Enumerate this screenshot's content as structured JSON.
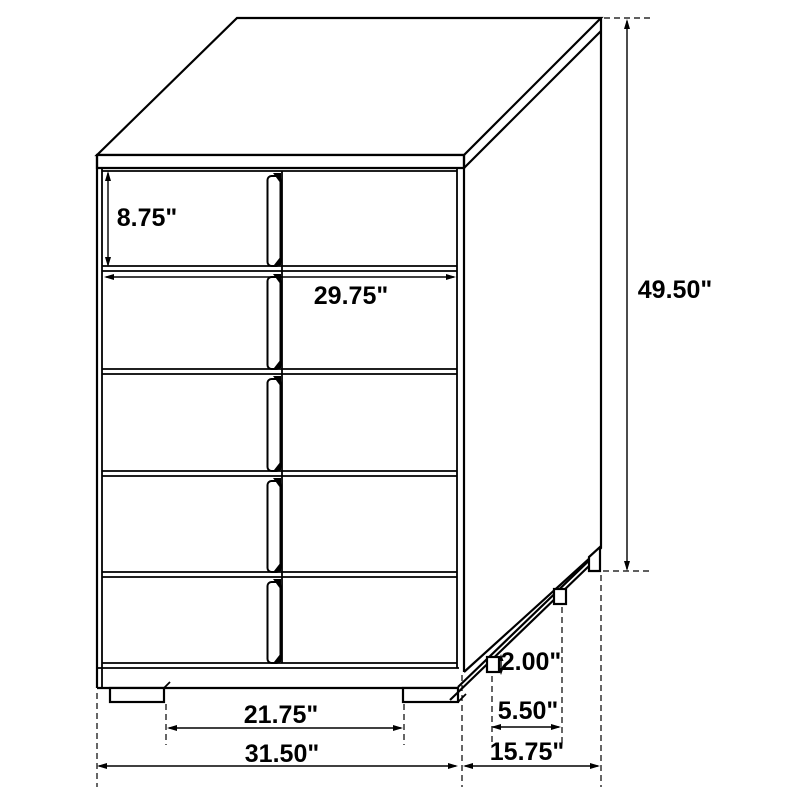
{
  "diagram": {
    "kind": "furniture-dimension-line-drawing",
    "colors": {
      "line": "#000000",
      "background": "#ffffff"
    },
    "labels": {
      "drawer_height": "8.75\"",
      "drawer_width": "29.75\"",
      "overall_height": "49.50\"",
      "foot_height": "2.00\"",
      "side_foot_spacing": "5.50\"",
      "front_foot_spacing": "21.75\"",
      "overall_width": "31.50\"",
      "overall_depth": "15.75\""
    }
  }
}
